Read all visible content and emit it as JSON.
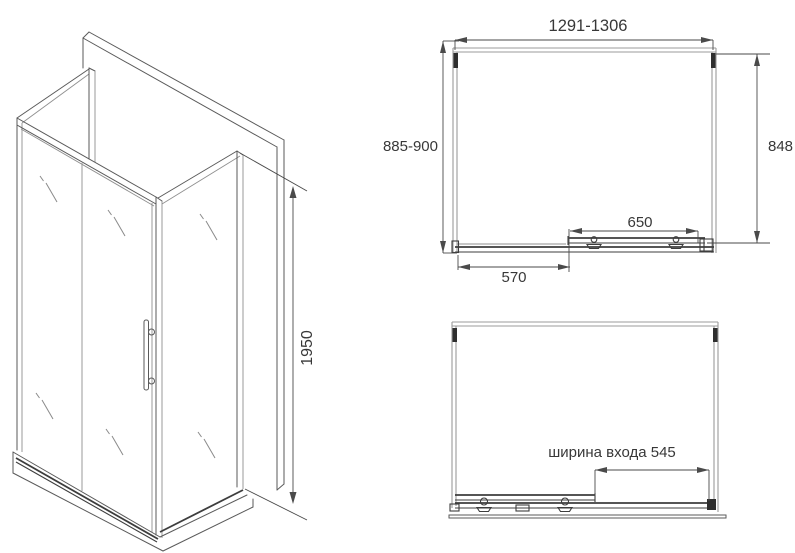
{
  "drawing": {
    "iso_view": {
      "height_label": "1950"
    },
    "top_view": {
      "width_label": "1291-1306",
      "left_depth_label": "885-900",
      "right_depth_label": "848",
      "door_label": "650",
      "panel_label": "570"
    },
    "front_view": {
      "entrance_label": "ширина входа 545"
    },
    "colors": {
      "background": "#ffffff",
      "line": "#5a5a5a",
      "glass_line": "#9b9b9b",
      "dark_rail": "#3d3d3d",
      "dimension": "#4a4a4a",
      "text": "#383838"
    }
  }
}
